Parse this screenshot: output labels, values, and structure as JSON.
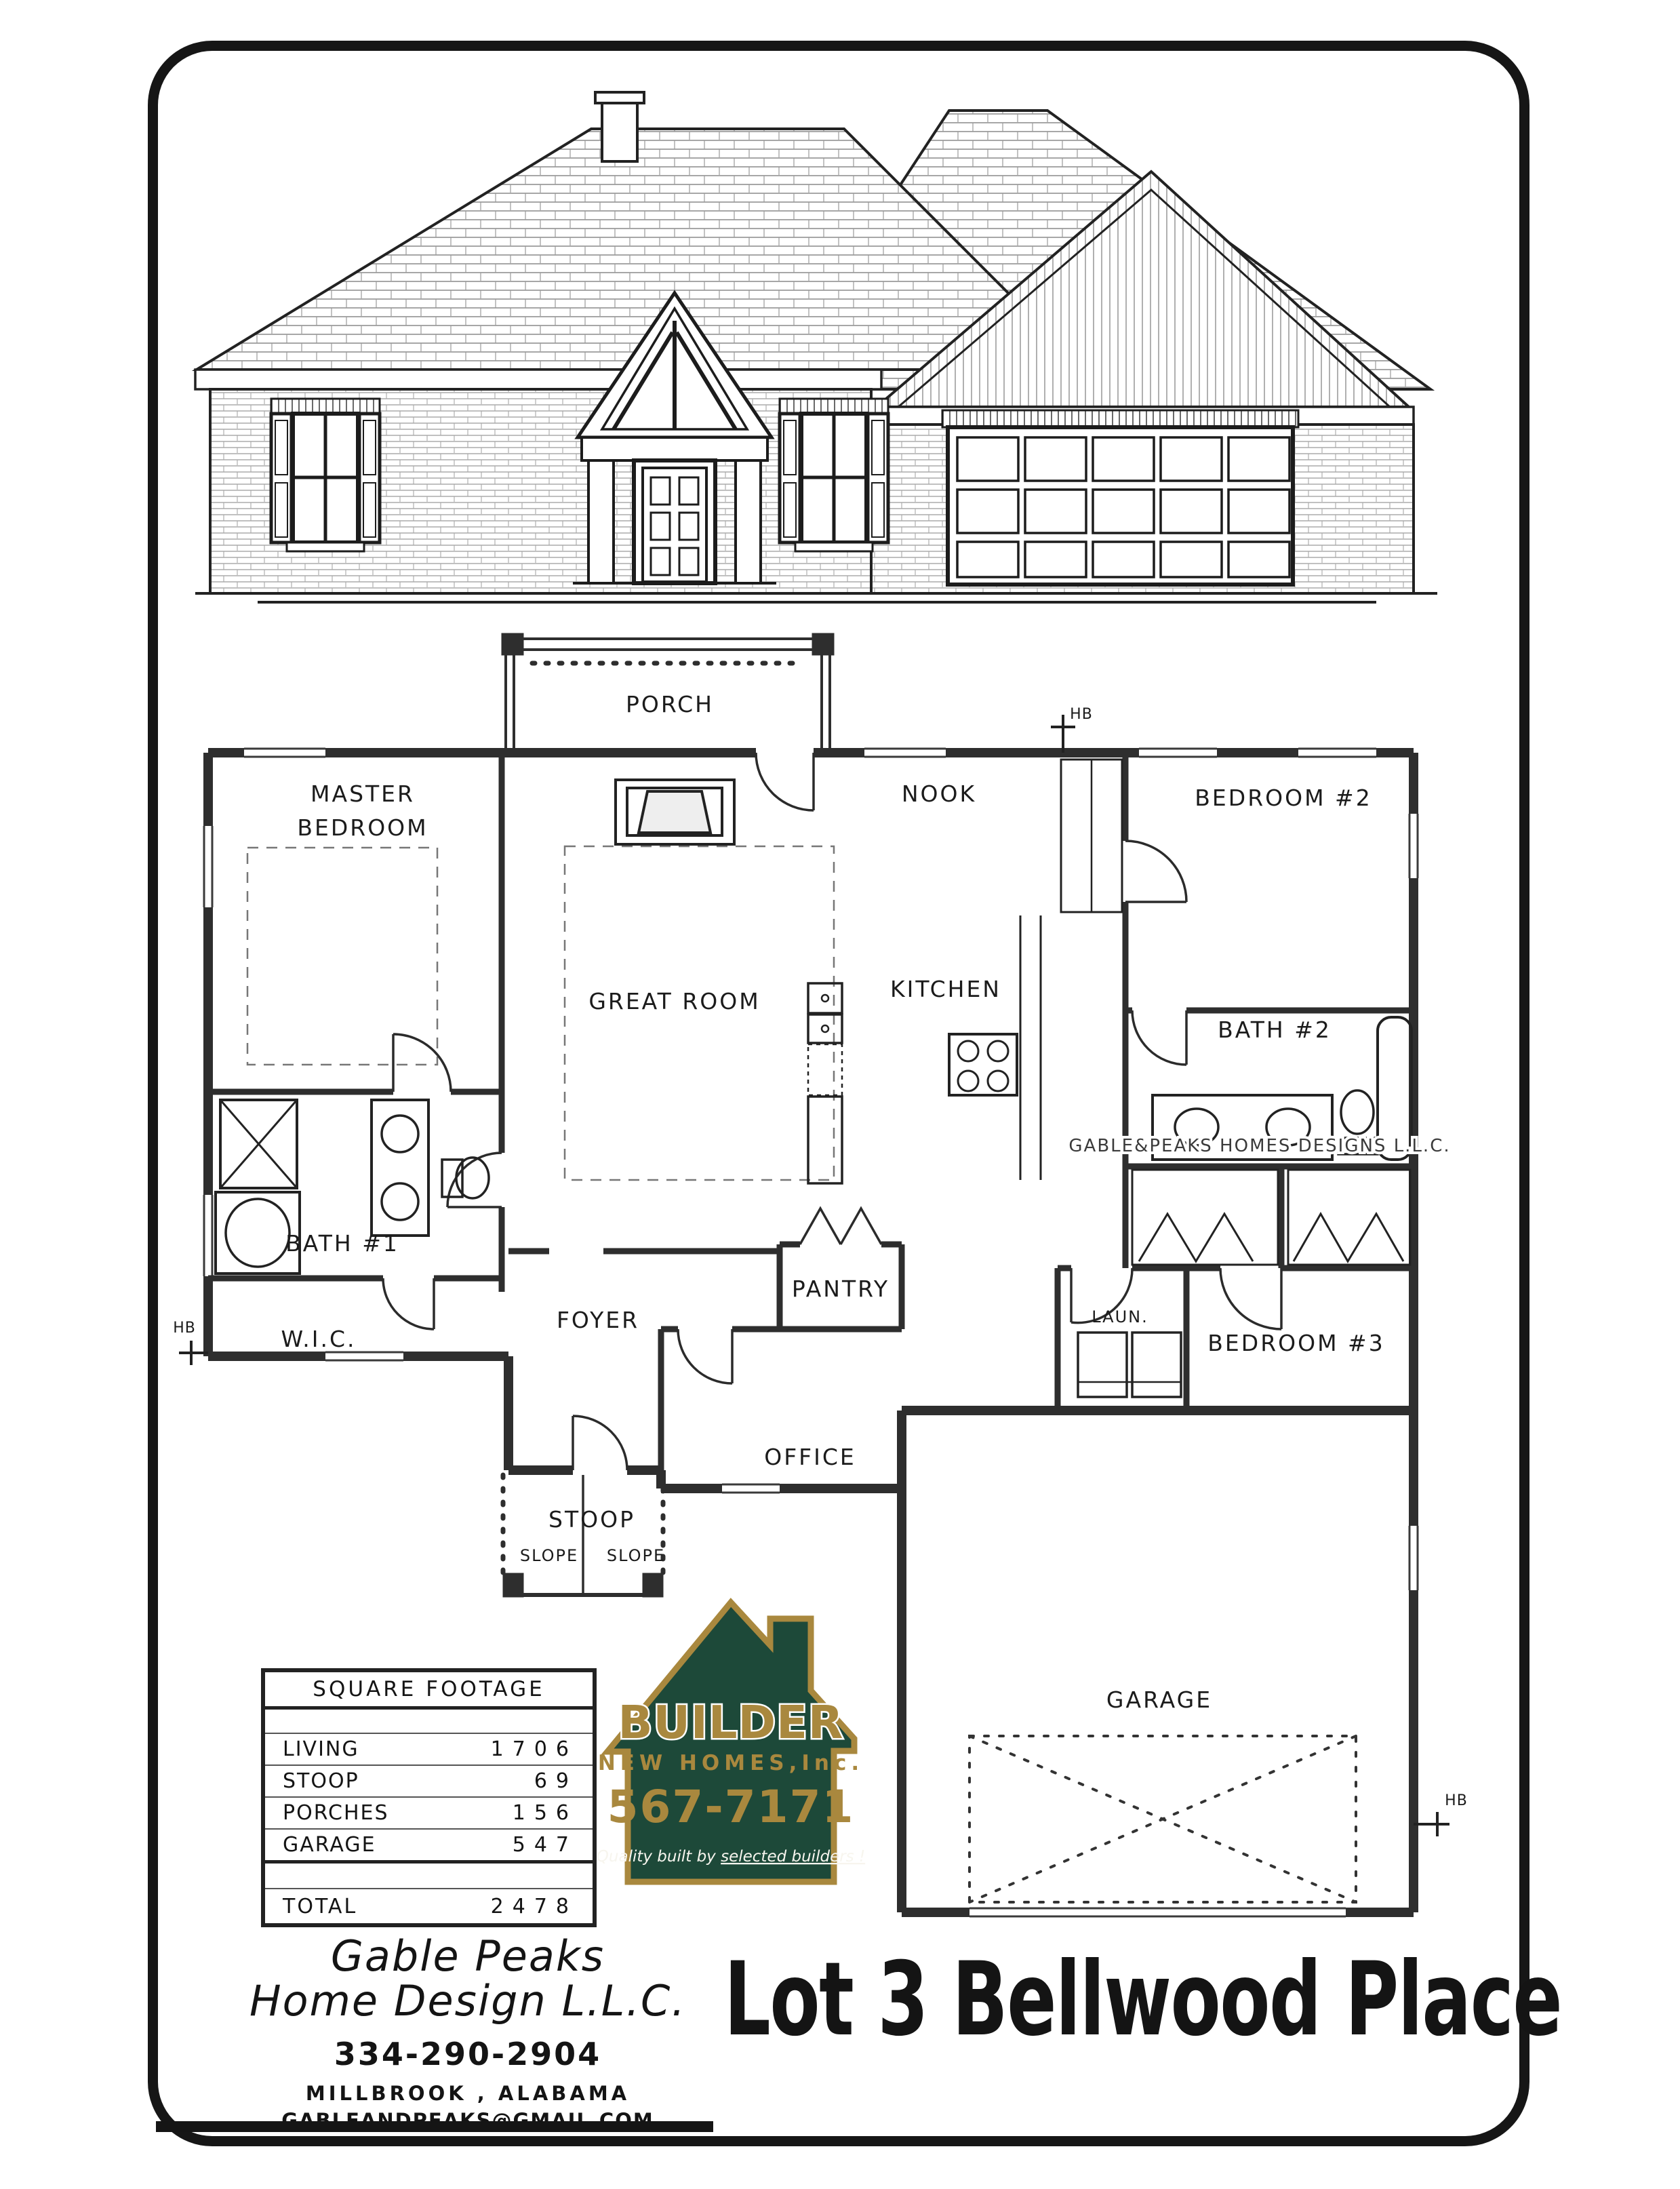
{
  "lot_title": "Lot 3 Bellwood Place",
  "designer": {
    "name_line1": "Gable Peaks",
    "name_line2": "Home Design L.L.C.",
    "phone": "334-290-2904",
    "location": "MILLBROOK , ALABAMA",
    "email": "GABLEANDPEAKS@GMAIL.COM"
  },
  "logo": {
    "name": "BUILDER",
    "subtitle": "NEW HOMES,Inc.",
    "phone": "567-7171",
    "tagline_a": "Quality built by ",
    "tagline_b": "selected builders !",
    "green_hex": "#1d4939",
    "gold_hex": "#a9883e",
    "white_hex": "#f7f5ee"
  },
  "footage_table": {
    "title": "SQUARE FOOTAGE",
    "rows": [
      {
        "label": "LIVING",
        "value": "1706"
      },
      {
        "label": "STOOP",
        "value": "69"
      },
      {
        "label": "PORCHES",
        "value": "156"
      },
      {
        "label": "GARAGE",
        "value": "547"
      }
    ],
    "total_label": "TOTAL",
    "total_value": "2478"
  },
  "floor_plan": {
    "watermark": "GABLE&PEAKS HOMES DESIGNS L.L.C.",
    "hose_bib_label": "HB",
    "rooms": {
      "porch": "PORCH",
      "master_line1": "MASTER",
      "master_line2": "BEDROOM",
      "nook": "NOOK",
      "bedroom2": "BEDROOM #2",
      "great_room": "GREAT ROOM",
      "kitchen": "KITCHEN",
      "bath2": "BATH #2",
      "bath1": "BATH #1",
      "wic": "W.I.C.",
      "foyer": "FOYER",
      "pantry": "PANTRY",
      "laundry": "LAUN.",
      "bedroom3": "BEDROOM #3",
      "office": "OFFICE",
      "stoop": "STOOP",
      "slope": "SLOPE",
      "garage": "GARAGE"
    }
  }
}
